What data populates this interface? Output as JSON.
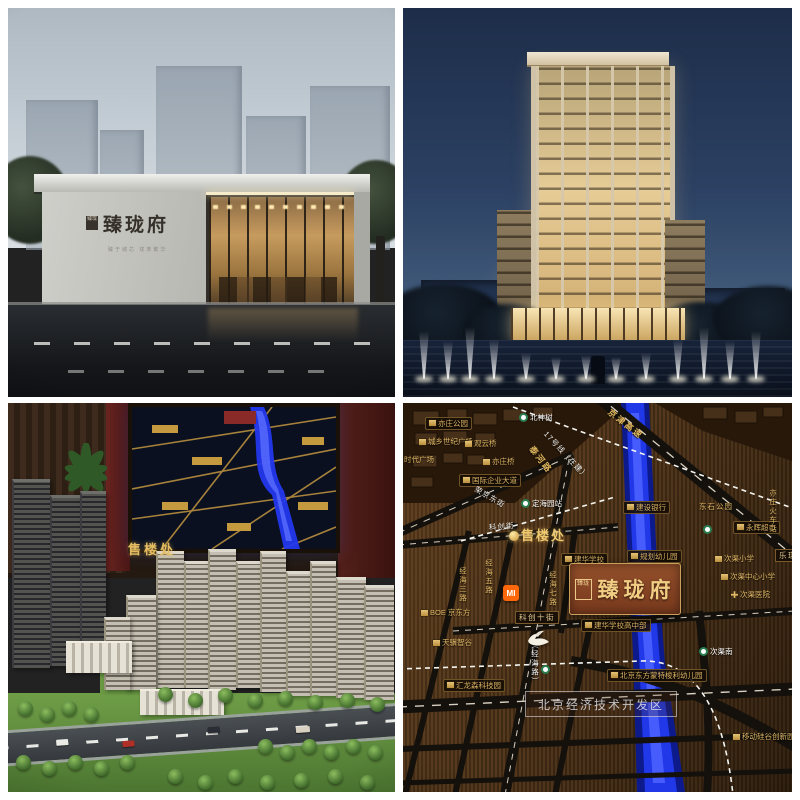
{
  "q1": {
    "sign": {
      "seal": "臻珑",
      "brand": "臻珑府",
      "tagline": "臻于城芯 珑萃繁华"
    }
  },
  "q3": {
    "wall_sign": "售楼处"
  },
  "q4": {
    "project": {
      "seal": "臻珑",
      "name": "臻珑府"
    },
    "mi": "MI",
    "watermark": "北京经济技术开发区",
    "labels": [
      {
        "t": "亦庄公园",
        "x": 22,
        "y": 14,
        "cls": "poib"
      },
      {
        "t": "城乡世纪广场",
        "x": 16,
        "y": 35,
        "cls": "poi"
      },
      {
        "t": "时代广场",
        "x": -8,
        "y": 53,
        "cls": "poi"
      },
      {
        "t": "观云桥",
        "x": 62,
        "y": 37,
        "cls": "poi"
      },
      {
        "t": "亦庄桥",
        "x": 80,
        "y": 55,
        "cls": "poi"
      },
      {
        "t": "国际企业大道",
        "x": 56,
        "y": 71,
        "cls": "poib"
      },
      {
        "t": "荣京东街",
        "x": 72,
        "y": 82,
        "cls": "rotw",
        "rot": 30
      },
      {
        "t": "北神树",
        "x": 116,
        "y": 10,
        "cls": "station"
      },
      {
        "t": "17号线（在建）",
        "x": 142,
        "y": 26,
        "cls": "rotw",
        "rot": 47
      },
      {
        "t": "京津高速",
        "x": 206,
        "y": 4,
        "cls": "rotg",
        "rot": 38
      },
      {
        "t": "泰河路",
        "x": 128,
        "y": 40,
        "cls": "rotg",
        "rot": 52
      },
      {
        "t": "定海园站",
        "x": 118,
        "y": 96,
        "cls": "station"
      },
      {
        "t": "建设银行",
        "x": 220,
        "y": 98,
        "cls": "poib"
      },
      {
        "t": "东石公园",
        "x": 296,
        "y": 100,
        "cls": "gold"
      },
      {
        "t": "永辉超市",
        "x": 330,
        "y": 118,
        "cls": "poib"
      },
      {
        "t": "亦庄火车站",
        "x": 366,
        "y": 86,
        "cls": "goldv"
      },
      {
        "t": "乐琪",
        "x": 372,
        "y": 146,
        "cls": "road"
      },
      {
        "t": "科创街",
        "x": 86,
        "y": 121,
        "cls": "rotw",
        "rot": -4
      },
      {
        "t": "售楼处",
        "x": 106,
        "y": 126,
        "cls": "sales"
      },
      {
        "t": "建华学校",
        "x": 158,
        "y": 150,
        "cls": "poib"
      },
      {
        "t": "规划幼儿园",
        "x": 224,
        "y": 147,
        "cls": "poib"
      },
      {
        "t": "经海三路",
        "x": 56,
        "y": 164,
        "cls": "goldv"
      },
      {
        "t": "经海五路",
        "x": 82,
        "y": 156,
        "cls": "goldv"
      },
      {
        "t": "经海七路",
        "x": 146,
        "y": 168,
        "cls": "goldv"
      },
      {
        "t": "科创十街",
        "x": 112,
        "y": 208,
        "cls": "road"
      },
      {
        "t": "建华学校高中部",
        "x": 178,
        "y": 216,
        "cls": "poib"
      },
      {
        "t": "北京东方蒙特梭利幼儿园",
        "x": 204,
        "y": 266,
        "cls": "poib"
      },
      {
        "t": "（经海路）",
        "x": 128,
        "y": 238,
        "cls": "whitev"
      },
      {
        "t": "BOE 京东方",
        "x": 18,
        "y": 206,
        "cls": "poi"
      },
      {
        "t": "天骥智谷",
        "x": 30,
        "y": 236,
        "cls": "poi"
      },
      {
        "t": "汇龙森科技园",
        "x": 40,
        "y": 276,
        "cls": "poib"
      },
      {
        "t": "次渠南",
        "x": 296,
        "y": 244,
        "cls": "station"
      },
      {
        "t": "次渠小学",
        "x": 312,
        "y": 152,
        "cls": "poi"
      },
      {
        "t": "次渠中心小学",
        "x": 318,
        "y": 170,
        "cls": "poi"
      },
      {
        "t": "次渠医院",
        "x": 328,
        "y": 188,
        "cls": "med"
      },
      {
        "t": "移动硅谷创新园",
        "x": 330,
        "y": 330,
        "cls": "poi"
      },
      {
        "t": "",
        "x": 138,
        "y": 262,
        "cls": "sticon"
      },
      {
        "t": "",
        "x": 300,
        "y": 122,
        "cls": "sticon"
      }
    ]
  }
}
